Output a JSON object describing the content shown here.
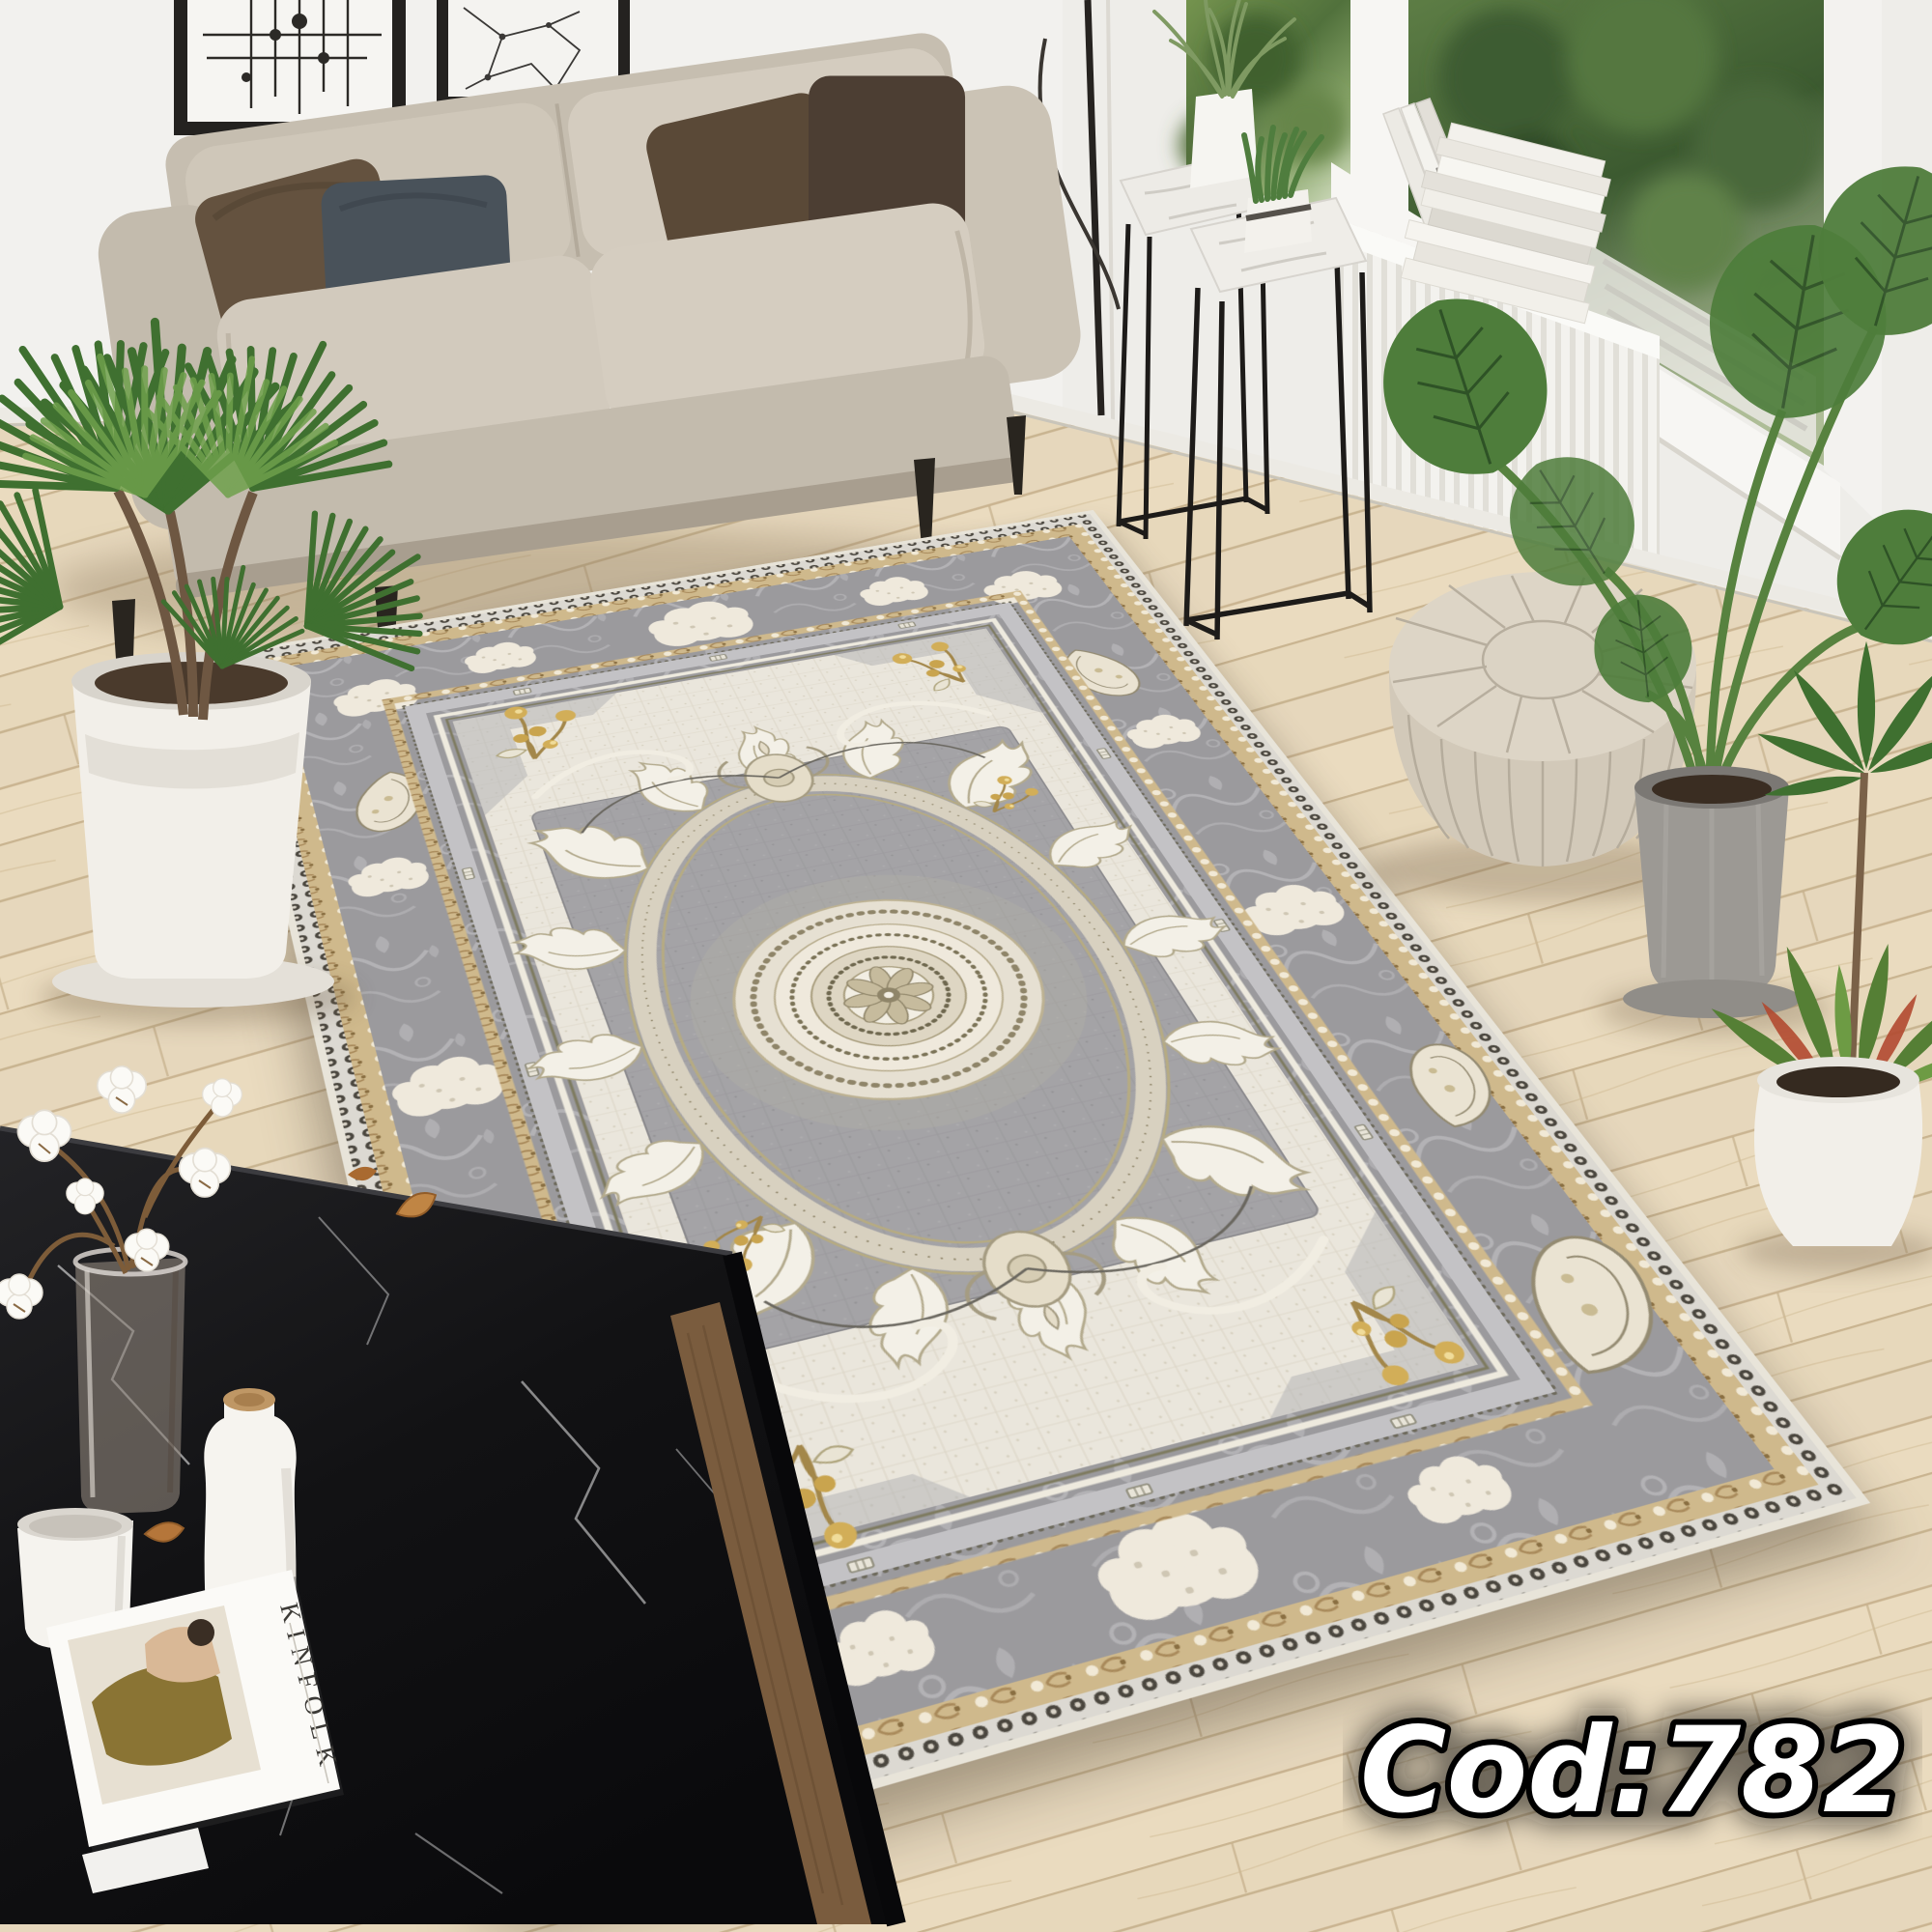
{
  "overlay": {
    "product_code_label": "Cod:782"
  },
  "coffee_table": {
    "magazine_title": "KINFOLK"
  },
  "window_area": {
    "book_spine_text": "Wrod"
  },
  "palette": {
    "wall": "#f2f1ee",
    "floor_light": "#ecdfc6",
    "floor_seam": "#c3ab87",
    "sofa_fabric": "#cfc7b9",
    "sofa_shade": "#b9b0a1",
    "pillow_dark_brown": "#64523f",
    "pillow_slate": "#49525a",
    "pillow_brown_right": "#5a4937",
    "pillow_umber_right": "#4c3e33",
    "rug_border_gray": "#9b9a9d",
    "rug_field_cream": "#eae6dc",
    "rug_center_gray": "#a4a3a6",
    "rug_gold": "#c9a95c",
    "rug_white_motif": "#f3f0e7",
    "rug_ring_cream": "#d8d1c0",
    "table_marble_black": "#151517",
    "pouf_beige": "#ddd5c6",
    "plant_green": "#4e7d3b",
    "plant_green_dark": "#3f7030",
    "plant_green_light": "#6fa04c",
    "croton_red": "#b24a30",
    "pot_white": "#f2efe9",
    "pot_concrete": "#9c9994",
    "wood_shelf": "#7a5c3e",
    "code_text_fill": "#ffffff",
    "code_text_outline": "#000000"
  }
}
